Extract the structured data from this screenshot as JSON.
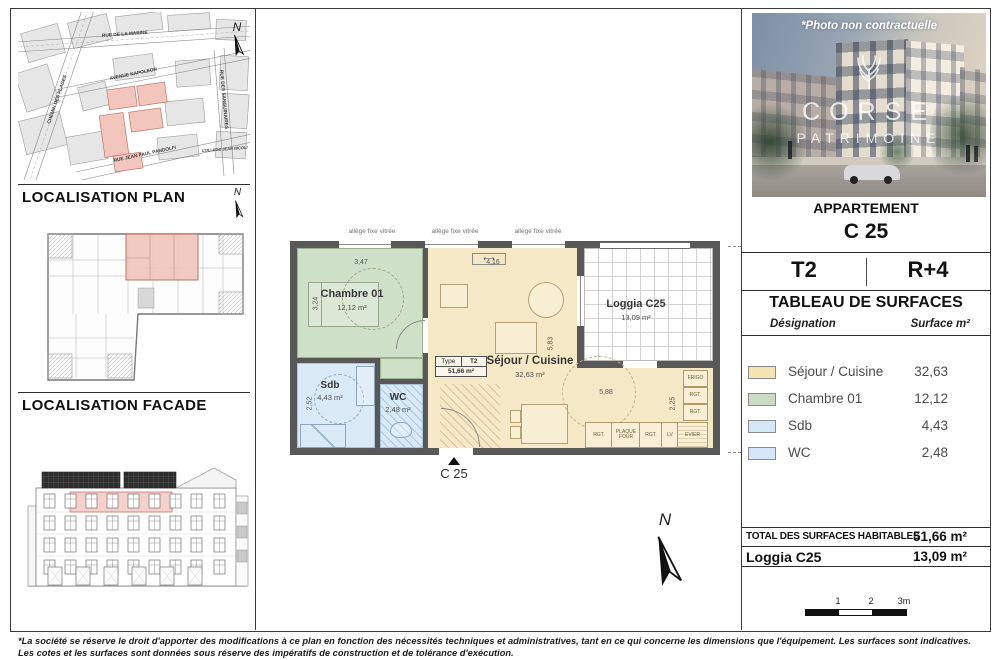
{
  "page": {
    "disclaimer1": "*La société se réserve le droit d'apporter des modifications à ce plan en fonction des nécessités techniques et administratives, tant en ce qui concerne les dimensions que l'équipement. Les surfaces sont indicatives.",
    "disclaimer2": "Les cotes et les surfaces sont données sous réserve des impératifs de construction et de tolérance d'exécution."
  },
  "map": {
    "title": "LOCALISATION PLAN",
    "north": "N",
    "street_marine": "RUE DE LA MARINE",
    "street_napoleon": "AVENUE NAPOLEON",
    "street_pandolfi": "RUE JEAN PAUL PANDOLFI",
    "street_plages": "CHEMIN DES PLAGES",
    "street_right": "RUE DES SANGUINAIRES",
    "place_college": "COLLEGE JEAN NICOLI"
  },
  "facade": {
    "title": "LOCALISATION FACADE"
  },
  "photo": {
    "caption": "*Photo non contractuelle",
    "brand_top": "CORSE",
    "brand_bottom": "PATRIMOINE"
  },
  "panel": {
    "header": "APPARTEMENT",
    "unit": "C 25",
    "type": "T2",
    "floor": "R+4",
    "table_title": "TABLEAU DE SURFACES",
    "col_designation": "Désignation",
    "col_surface": "Surface m²",
    "rows": [
      {
        "label": "Séjour / Cuisine",
        "value": "32,63",
        "color": "#f5e3b3"
      },
      {
        "label": "Chambre 01",
        "value": "12,12",
        "color": "#ccdcc4"
      },
      {
        "label": "Sdb",
        "value": "4,43",
        "color": "#d6e7f7"
      },
      {
        "label": "WC",
        "value": "2,48",
        "color": "#d6e7f7"
      }
    ],
    "total_label": "TOTAL DES SURFACES HABITABLES",
    "total_value": "51,66 m²",
    "loggia_label": "Loggia C25",
    "loggia_value": "13,09 m²"
  },
  "plan": {
    "allege1": "allège fixe vitrée",
    "allege2": "allège fixe vitrée",
    "allege3": "allège fixe vitrée",
    "marker": "C 25",
    "north": "N",
    "rooms": {
      "chambre_name": "Chambre 01",
      "chambre_area": "12,12 m²",
      "sejour_name": "Séjour / Cuisine",
      "sejour_area": "32,63 m²",
      "sdb_name": "Sdb",
      "sdb_area": "4,43 m²",
      "wc_name": "WC",
      "wc_area": "2,48 m²",
      "loggia_name": "Loggia C25",
      "loggia_area": "13,09 m²"
    },
    "typebox": {
      "label": "Type",
      "type": "T2",
      "area": "51,66 m²"
    },
    "dims": {
      "w_chambre": "3,47",
      "w_sejour": "4,16",
      "h_chambre": "3,24",
      "h_sdb": "2,52",
      "h_sejour": "5,83",
      "w_kitchen": "5,88",
      "h_kitchen": "2,25"
    },
    "kitchen": {
      "frigo": "FRIGO",
      "rgt1": "RGT.",
      "rgt2": "RGT.",
      "rgt3": "RGT.",
      "plaque": "PLAQUE FOUR",
      "rgt4": "RGT.",
      "lv": "LV",
      "evier": "EVIER"
    }
  },
  "scalebar": {
    "t1": "1",
    "t2": "2",
    "t3": "3m"
  }
}
